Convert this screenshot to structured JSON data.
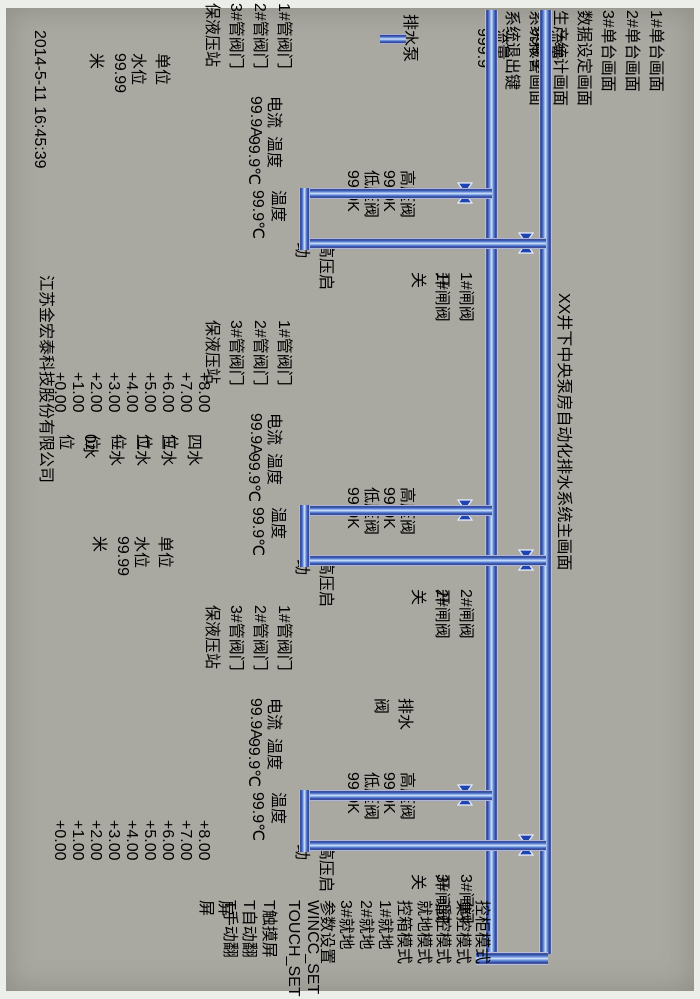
{
  "title": {
    "text": "XX井下中央泵房自动化排水系统主画面"
  },
  "footer": {
    "datetime": "2014-5-11  16:45:39",
    "company": "江苏金宏泰科技股份有限公司"
  },
  "nav": {
    "buttons": [
      "1#单台画面",
      "2#单台画面",
      "3#单台画面",
      "数据设定画面",
      "生产统计画面",
      "系统报警画面",
      "系统退出键"
    ]
  },
  "side_panel": {
    "buttons": [
      {
        "label": "控柜模式",
        "accent": true
      },
      {
        "label": "集控模式",
        "accent": false
      },
      {
        "label": "遥控模式",
        "accent": false
      },
      {
        "label": "就地模式",
        "accent": false
      },
      {
        "label": "控箱模式",
        "accent": true
      },
      {
        "label": "1#就地",
        "accent": false
      },
      {
        "label": "2#就地",
        "accent": false
      },
      {
        "label": "3#就地",
        "accent": false
      },
      {
        "label": "参数设置",
        "accent": true
      },
      {
        "label": "WINCC_SET",
        "accent": false
      },
      {
        "label": "TOUCH_SET",
        "accent": false
      },
      {
        "label": "T触摸屏",
        "accent": true
      },
      {
        "label": "T自动翻屏",
        "accent": false
      },
      {
        "label": "T手动翻屏",
        "accent": false
      }
    ]
  },
  "flow_meters": [
    {
      "label": "流量",
      "value": "999.9"
    },
    {
      "label": "流量",
      "value": "999.9"
    }
  ],
  "pumps": [
    {
      "gate_open": "1#闸阀开",
      "gate_close": "1#闸阀关",
      "hp_valve": "高压阀",
      "hp_value": "99.9K",
      "lp_valve": "低压阀",
      "lp_value": "99.9K",
      "hv_start": "高压启动",
      "pump_temp_label": "温度",
      "pump_temp": "99.9℃",
      "motor_current_label": "电流",
      "motor_current": "99.9A",
      "motor_temp_label": "温度",
      "motor_temp": "99.9℃",
      "hydraulic_title": "保液压站",
      "hydraulic_valves": [
        "1#管阀门",
        "2#管阀门",
        "3#管阀门"
      ]
    },
    {
      "gate_open": "2#闸阀开",
      "gate_close": "2#闸阀关",
      "hp_valve": "高压阀",
      "hp_value": "99.9K",
      "lp_valve": "低压阀",
      "lp_value": "99.9K",
      "hv_start": "高压启动",
      "pump_temp_label": "温度",
      "pump_temp": "99.9℃",
      "motor_current_label": "电流",
      "motor_current": "99.9A",
      "motor_temp_label": "温度",
      "motor_temp": "99.9℃",
      "hydraulic_title": "保液压站",
      "hydraulic_valves": [
        "1#管阀门",
        "2#管阀门",
        "3#管阀门"
      ]
    },
    {
      "gate_open": "3#闸阀开",
      "gate_close": "3#闸阀关",
      "hp_valve": "高压阀",
      "hp_value": "99.9K",
      "lp_valve": "低压阀",
      "lp_value": "99.9K",
      "hv_start": "高压启动",
      "pump_temp_label": "温度",
      "pump_temp": "99.9℃",
      "motor_current_label": "电流",
      "motor_current": "99.9A",
      "motor_temp_label": "温度",
      "motor_temp": "99.9℃",
      "hydraulic_title": "保液压站",
      "hydraulic_valves": [
        "1#管阀门",
        "2#管阀门",
        "3#管阀门"
      ]
    }
  ],
  "tanks": [
    {
      "scale": [
        "+8.00",
        "+7.00",
        "+6.00",
        "+5.00",
        "+4.00",
        "+3.00",
        "+2.00",
        "+1.00",
        "+0.00"
      ],
      "display": {
        "label1": "单位",
        "label2": "水位",
        "value": "99.99",
        "unit": "米"
      },
      "level_buttons": [
        "四水位",
        "三水位",
        "二水位",
        "一水位",
        "0水位"
      ]
    },
    {
      "scale": [
        "+8.00",
        "+7.00",
        "+6.00",
        "+5.00",
        "+4.00",
        "+3.00",
        "+2.00",
        "+1.00",
        "+0.00"
      ],
      "display": {
        "label1": "单位",
        "label2": "水位",
        "value": "99.99",
        "unit": "米"
      },
      "level_buttons": []
    }
  ],
  "misc": {
    "drain_valve": "排水阀",
    "drain_pump": "排水泵"
  },
  "colors": {
    "accent_teal": "#2e9da6",
    "pipe_blue": "#1d44b0",
    "signal_green": "#9fd35e",
    "alarm_red": "#d03020",
    "panel_gray": "#a9a8a1",
    "nav_green": "#b7cf92",
    "bar_brown": "#a55c39"
  }
}
